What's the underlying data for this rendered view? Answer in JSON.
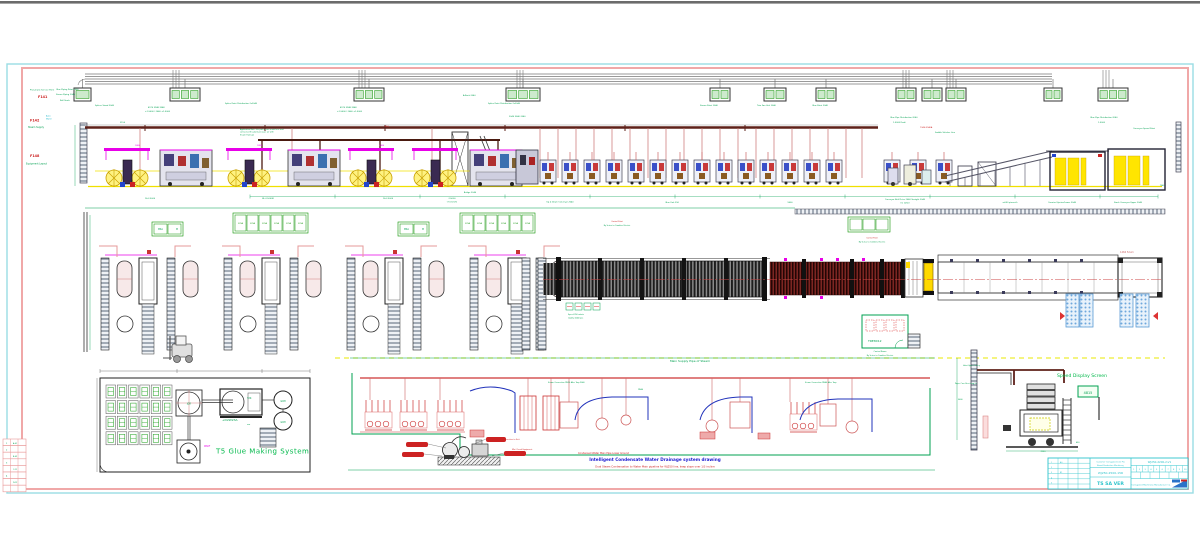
{
  "colors": {
    "frame_cyan": "#9ADDE3",
    "frame_pink": "#F0A8A8",
    "green": "#00A050",
    "bright_green": "#00B84A",
    "red": "#CC2222",
    "magenta": "#E800E8",
    "yellow": "#FFE500",
    "brown_rail": "#5E2019",
    "blue_pipe": "#2233BB",
    "title_cyan": "#2EC4CC",
    "top_bar_gray": "#6B6B6B"
  },
  "glue_system": {
    "title": "T5 Glue Making System",
    "grid": {
      "rows": 4,
      "cols": 6
    },
    "mixer_label": "JGR",
    "tank_label": "Y2K",
    "tank_sub": "+D2W23A",
    "pump_label": "W60F"
  },
  "piping": {
    "top_label": "Main Supply Pipe of Steam",
    "title": "Intelligent Condensate Water Drainage system drawing",
    "subtitle": "Dual Steam Condensation to Water Main pipeline for WJ250 line, keep slope over 1/3 incline",
    "condensate_label": "Condensed Water Main Pipe Lower Ground"
  },
  "side_view": {
    "label": "Speed Display Screen",
    "screen_text": "4815"
  },
  "plan": {
    "room_label": "TRE8X12",
    "conveyor_note": "1466 52um",
    "units": [
      95,
      218,
      341,
      464
    ],
    "pallets": [
      [
        1066,
        294
      ],
      [
        1080,
        294
      ],
      [
        1120,
        294
      ],
      [
        1136,
        294
      ]
    ],
    "strips": [
      {
        "x": 152,
        "y": 222,
        "cells": 2,
        "cw": 13,
        "ch": 10
      },
      {
        "x": 398,
        "y": 222,
        "cells": 2,
        "cw": 13,
        "ch": 10
      },
      {
        "x": 233,
        "y": 213,
        "cells": 6,
        "cw": 11,
        "ch": 16,
        "t": "370A"
      },
      {
        "x": 460,
        "y": 213,
        "cells": 6,
        "cw": 11,
        "ch": 16,
        "t": "370A"
      },
      {
        "x": 848,
        "y": 217,
        "cells": 3,
        "cw": 12,
        "ch": 11
      }
    ]
  },
  "elevation": {
    "control_boxes": [
      {
        "x": 74,
        "w": 17,
        "c": 1
      },
      {
        "x": 170,
        "w": 30,
        "c": 3
      },
      {
        "x": 354,
        "w": 30,
        "c": 3
      },
      {
        "x": 506,
        "w": 34,
        "c": 3
      },
      {
        "x": 710,
        "w": 20,
        "c": 2
      },
      {
        "x": 764,
        "w": 22,
        "c": 2
      },
      {
        "x": 816,
        "w": 20,
        "c": 2
      },
      {
        "x": 896,
        "w": 20,
        "c": 2
      },
      {
        "x": 922,
        "w": 20,
        "c": 2
      },
      {
        "x": 946,
        "w": 20,
        "c": 2
      },
      {
        "x": 1044,
        "w": 18,
        "c": 2
      },
      {
        "x": 1098,
        "w": 30,
        "c": 3
      }
    ],
    "risers": [
      176,
      362,
      520,
      906,
      950,
      1106
    ],
    "red_drops": [
      140,
      292,
      432,
      540,
      558,
      576,
      594,
      612,
      630,
      648,
      666,
      684,
      702,
      720,
      738,
      756,
      774,
      792,
      810,
      828,
      846,
      862
    ],
    "sf_units": [
      540,
      562,
      584,
      606,
      628,
      650,
      672,
      694,
      716,
      738,
      760,
      782,
      804,
      826,
      884,
      910,
      936
    ],
    "roll_stands": [
      104,
      226,
      348,
      412
    ],
    "dark_machines": [
      160,
      288,
      470
    ],
    "dim_ticks": [
      250,
      335,
      420,
      505,
      590,
      675,
      760,
      845,
      930,
      1015,
      1100,
      1158
    ]
  },
  "title_block": {
    "customer_1": "Customer Corrugated Line Pro",
    "customer_2": "Board Production Machinery",
    "project_no": "WJ250-2500-15R",
    "name": "TS SA VER",
    "drawing_no": "WJ250-2200-2-V1",
    "company": "Corrugated Machinery Manufacture Co.",
    "scale_row": [
      "1",
      "2",
      "3",
      "4",
      "5",
      "6",
      "7",
      "8",
      "9",
      "10"
    ]
  },
  "scatter_labels": [
    {
      "x": 30,
      "y": 90.5,
      "t": "Pneumatic Service Point",
      "c": "#00A050",
      "s": 2
    },
    {
      "x": 56,
      "y": 90,
      "t": "Glue Piping Point 2040",
      "c": "#00A050",
      "s": 2
    },
    {
      "x": 38,
      "y": 98,
      "t": "F141",
      "c": "#CC2222",
      "s": 3.4,
      "b": 1
    },
    {
      "x": 56,
      "y": 95,
      "t": "Steam Piping 2040",
      "c": "#00A050",
      "s": 2
    },
    {
      "x": 30,
      "y": 121.5,
      "t": "F142",
      "c": "#CC2222",
      "s": 3.4,
      "b": 1
    },
    {
      "x": 46,
      "y": 116.5,
      "t": "Auto",
      "c": "#18B4C8",
      "s": 2
    },
    {
      "x": 46,
      "y": 119.5,
      "t": "Water",
      "c": "#18B4C8",
      "s": 2
    },
    {
      "x": 28,
      "y": 128,
      "t": "Steam Supply",
      "c": "#00A050",
      "s": 2.3
    },
    {
      "x": 30,
      "y": 157,
      "t": "F148",
      "c": "#CC2222",
      "s": 3.4,
      "b": 1
    },
    {
      "x": 26,
      "y": 164.5,
      "t": "Equipment Layout",
      "c": "#00A050",
      "s": 2.3
    },
    {
      "x": 95,
      "y": 106,
      "t": "Splicer Stand 2040",
      "c": "#00A050",
      "s": 2
    },
    {
      "x": 60,
      "y": 101,
      "t": "Roll Stock",
      "c": "#00A050",
      "s": 2
    },
    {
      "x": 148,
      "y": 108,
      "t": "4970 3948 3948",
      "c": "#00A050",
      "s": 2
    },
    {
      "x": 145,
      "y": 112,
      "t": "+1,5000 / 2040 +1,5000",
      "c": "#00A050",
      "s": 2
    },
    {
      "x": 225,
      "y": 104,
      "t": "Splice Point Distribution 2x2040",
      "c": "#00A050",
      "s": 2
    },
    {
      "x": 340,
      "y": 108,
      "t": "4970 3948 3948",
      "c": "#00A050",
      "s": 2
    },
    {
      "x": 337,
      "y": 112,
      "t": "+1,5000 / 2040 +1,5000",
      "c": "#00A050",
      "s": 2
    },
    {
      "x": 488,
      "y": 104,
      "t": "Splice Point Distribution 2x2040",
      "c": "#00A050",
      "s": 2
    },
    {
      "x": 509,
      "y": 117,
      "t": "2040  3040  2040",
      "c": "#00A050",
      "s": 2
    },
    {
      "x": 463,
      "y": 96,
      "t": "A-Rack 2040",
      "c": "#00A050",
      "s": 2
    },
    {
      "x": 700,
      "y": 106,
      "t": "Steam Point 2040",
      "c": "#00A050",
      "s": 2
    },
    {
      "x": 757,
      "y": 106,
      "t": "Trim Fan Unit 2040",
      "c": "#00A050",
      "s": 2
    },
    {
      "x": 812,
      "y": 106,
      "t": "Glue Point 2040",
      "c": "#00A050",
      "s": 2
    },
    {
      "x": 890,
      "y": 118,
      "t": "Glue Pipe Distribution 2040",
      "c": "#00A050",
      "s": 2
    },
    {
      "x": 893,
      "y": 123,
      "t": "1,5000  Prahi",
      "c": "#00A050",
      "s": 2
    },
    {
      "x": 920,
      "y": 128,
      "t": "7340-9940A",
      "c": "#CC2222",
      "s": 2
    },
    {
      "x": 935,
      "y": 133,
      "t": "Saddle Stitcher Line",
      "c": "#00A050",
      "s": 2
    },
    {
      "x": 1090,
      "y": 118,
      "t": "Glue Pipe Distribution 2040",
      "c": "#00A050",
      "s": 2
    },
    {
      "x": 1098,
      "y": 123,
      "t": "1,5000",
      "c": "#00A050",
      "s": 2
    },
    {
      "x": 1133,
      "y": 129,
      "t": "Conveyor Speed Point",
      "c": "#00A050",
      "s": 2
    },
    {
      "x": 120,
      "y": 123,
      "t": "3150",
      "c": "#00A050",
      "s": 2
    },
    {
      "x": 240,
      "y": 130,
      "t": "Application Note: the pallets can reach here and",
      "c": "#00A050",
      "s": 1.8
    },
    {
      "x": 240,
      "y": 132.7,
      "t": "connected the plant pressure air with",
      "c": "#00A050",
      "s": 1.8
    },
    {
      "x": 240,
      "y": 135.4,
      "t": "Steam Trams-A",
      "c": "#00A050",
      "s": 1.8
    },
    {
      "x": 385,
      "y": 127,
      "t": "B50",
      "c": "#CC2222",
      "s": 2
    },
    {
      "x": 135,
      "y": 146,
      "t": "1880",
      "c": "#E800E8",
      "s": 2
    },
    {
      "x": 257,
      "y": 146,
      "t": "1880",
      "c": "#E800E8",
      "s": 2
    },
    {
      "x": 379,
      "y": 146,
      "t": "1880",
      "c": "#E800E8",
      "s": 2
    },
    {
      "x": 150,
      "y": 199,
      "t": "16-2,5000",
      "c": "#00A050",
      "s": 2,
      "a": "middle"
    },
    {
      "x": 268,
      "y": 199,
      "t": "BL-2,5000R",
      "c": "#00A050",
      "s": 2,
      "a": "middle"
    },
    {
      "x": 388,
      "y": 199,
      "t": "16-2,5000",
      "c": "#00A050",
      "s": 2,
      "a": "middle"
    },
    {
      "x": 452,
      "y": 199,
      "t": "2,5000",
      "c": "#00A050",
      "s": 2,
      "a": "middle"
    },
    {
      "x": 452,
      "y": 202.5,
      "t": "(7.5 km/h)",
      "c": "#00A050",
      "s": 2,
      "a": "middle"
    },
    {
      "x": 470,
      "y": 193,
      "t": "Bridge 2040",
      "c": "#00A050",
      "s": 2,
      "a": "middle"
    },
    {
      "x": 560,
      "y": 202.5,
      "t": "Up & Down Conveyor 2040",
      "c": "#00A050",
      "s": 2,
      "a": "middle"
    },
    {
      "x": 672,
      "y": 203,
      "t": "Glue Unit 250",
      "c": "#00A050",
      "s": 2,
      "a": "middle"
    },
    {
      "x": 790,
      "y": 203,
      "t": "9600",
      "c": "#00A050",
      "s": 2,
      "a": "middle"
    },
    {
      "x": 905,
      "y": 200,
      "t": "Conveyor Belt Drive 2040 Straight 2040",
      "c": "#00A050",
      "s": 2,
      "a": "middle"
    },
    {
      "x": 905,
      "y": 203.5,
      "t": "(m 1250)",
      "c": "#00A050",
      "s": 2,
      "a": "middle"
    },
    {
      "x": 1010,
      "y": 203,
      "t": "a-650 pieces/h",
      "c": "#00A050",
      "s": 2,
      "a": "middle"
    },
    {
      "x": 1062,
      "y": 203,
      "t": "Counter Ejector/Lower 2040",
      "c": "#00A050",
      "s": 2,
      "a": "middle"
    },
    {
      "x": 1128,
      "y": 203,
      "t": "Stack Conveyor Upper 2040",
      "c": "#00A050",
      "s": 2,
      "a": "middle"
    },
    {
      "x": 1162,
      "y": 186,
      "t": "7540",
      "c": "#00A050",
      "s": 1.8,
      "a": "middle"
    },
    {
      "x": 158,
      "y": 230,
      "t": "MSA",
      "c": "#00A050",
      "s": 2.2
    },
    {
      "x": 176,
      "y": 230,
      "t": "M",
      "c": "#00A050",
      "s": 2.2
    },
    {
      "x": 404,
      "y": 230,
      "t": "MSA",
      "c": "#00A050",
      "s": 2.2
    },
    {
      "x": 422,
      "y": 230,
      "t": "M",
      "c": "#00A050",
      "s": 2.2
    },
    {
      "x": 617,
      "y": 222,
      "t": "Control Point",
      "c": "#CC2222",
      "s": 1.8,
      "a": "middle"
    },
    {
      "x": 617,
      "y": 226,
      "t": "By Series to Combine Electric",
      "c": "#00A050",
      "s": 1.8,
      "a": "middle"
    },
    {
      "x": 872,
      "y": 238.5,
      "t": "Control Point",
      "c": "#CC2222",
      "s": 1.8,
      "a": "middle"
    },
    {
      "x": 872,
      "y": 242.5,
      "t": "By Series to Combine Electric",
      "c": "#00A050",
      "s": 1.8,
      "a": "middle"
    },
    {
      "x": 568,
      "y": 315,
      "t": "Speed 250 m/min",
      "c": "#00A050",
      "s": 1.8
    },
    {
      "x": 568,
      "y": 318.5,
      "t": "Quality 2040 pcs",
      "c": "#00A050",
      "s": 1.8
    },
    {
      "x": 880,
      "y": 352,
      "t": "Control Room",
      "c": "#00A050",
      "s": 1.9,
      "a": "middle"
    },
    {
      "x": 880,
      "y": 356,
      "t": "By Series to Combine Electric",
      "c": "#00A050",
      "s": 1.8,
      "a": "middle"
    },
    {
      "x": 189,
      "y": 404.5,
      "t": "JGR",
      "c": "#00A050",
      "s": 2.3,
      "a": "middle"
    },
    {
      "x": 247,
      "y": 399,
      "t": "Y2K",
      "c": "#00A050",
      "s": 2.3
    },
    {
      "x": 222,
      "y": 421,
      "t": "+D2W23A",
      "c": "#00A050",
      "s": 3
    },
    {
      "x": 247,
      "y": 425,
      "t": "um",
      "c": "#00A050",
      "s": 2
    },
    {
      "x": 283,
      "y": 402,
      "t": "GCM",
      "c": "#00A050",
      "s": 2.2,
      "a": "middle"
    },
    {
      "x": 283,
      "y": 423,
      "t": "GCM",
      "c": "#00A050",
      "s": 2.2,
      "a": "middle"
    },
    {
      "x": 204,
      "y": 447,
      "t": "W60F",
      "c": "#E800E8",
      "s": 2.2
    },
    {
      "x": 548,
      "y": 383,
      "t": "Steam Connection DN25 After Trap 2040",
      "c": "#00A050",
      "s": 1.8
    },
    {
      "x": 638,
      "y": 390,
      "t": "DN40",
      "c": "#00A050",
      "s": 1.8
    },
    {
      "x": 805,
      "y": 383,
      "t": "Steam Connection DN40 After Trap",
      "c": "#00A050",
      "s": 1.8
    },
    {
      "x": 512,
      "y": 450,
      "t": "Mini Circuit Equipment",
      "c": "#CC2222",
      "s": 1.8
    },
    {
      "x": 492,
      "y": 440,
      "t": "Steam Trap Connection to Unit",
      "c": "#CC2222",
      "s": 1.8
    },
    {
      "x": 963,
      "y": 366,
      "t": "Hoist Upper Trolley",
      "c": "#00A050",
      "s": 1.8
    },
    {
      "x": 955,
      "y": 384,
      "t": "Paper Core Receiving 2x",
      "c": "#00A050",
      "s": 1.8
    },
    {
      "x": 958,
      "y": 400,
      "t": "5600",
      "c": "#00A050",
      "s": 1.8
    },
    {
      "x": 1043,
      "y": 452,
      "t": "2950",
      "c": "#00A050",
      "s": 1.9,
      "a": "middle"
    },
    {
      "x": 1076,
      "y": 443,
      "t": "450",
      "c": "#00A050",
      "s": 1.8
    },
    {
      "x": 6,
      "y": 444,
      "t": "1",
      "c": "#00A050",
      "s": 2
    },
    {
      "x": 13,
      "y": 444,
      "t": "A-01",
      "c": "#00A050",
      "s": 1.8
    },
    {
      "x": 6,
      "y": 450.5,
      "t": "2",
      "c": "#00A050",
      "s": 2
    },
    {
      "x": 13,
      "y": 457,
      "t": "B-02",
      "c": "#00A050",
      "s": 1.8
    },
    {
      "x": 6,
      "y": 463.5,
      "t": "3",
      "c": "#00A050",
      "s": 2
    },
    {
      "x": 13,
      "y": 470,
      "t": "C-11",
      "c": "#00A050",
      "s": 1.8
    },
    {
      "x": 6,
      "y": 476.5,
      "t": "4",
      "c": "#00A050",
      "s": 2
    },
    {
      "x": 13,
      "y": 483,
      "t": "D-12",
      "c": "#00A050",
      "s": 1.8
    },
    {
      "x": 1051,
      "y": 462.8,
      "t": "1",
      "c": "#2EC4CC",
      "s": 1.8
    },
    {
      "x": 1051,
      "y": 468,
      "t": "2",
      "c": "#2EC4CC",
      "s": 1.8
    },
    {
      "x": 1051,
      "y": 473.2,
      "t": "3",
      "c": "#2EC4CC",
      "s": 1.8
    },
    {
      "x": 1051,
      "y": 478.4,
      "t": "4",
      "c": "#2EC4CC",
      "s": 1.8
    },
    {
      "x": 1051,
      "y": 483.6,
      "t": "5",
      "c": "#2EC4CC",
      "s": 1.8
    },
    {
      "x": 1060,
      "y": 462.8,
      "t": "A0",
      "c": "#2EC4CC",
      "s": 1.8
    },
    {
      "x": 1060,
      "y": 473.2,
      "t": "B1",
      "c": "#2EC4CC",
      "s": 1.8
    }
  ]
}
